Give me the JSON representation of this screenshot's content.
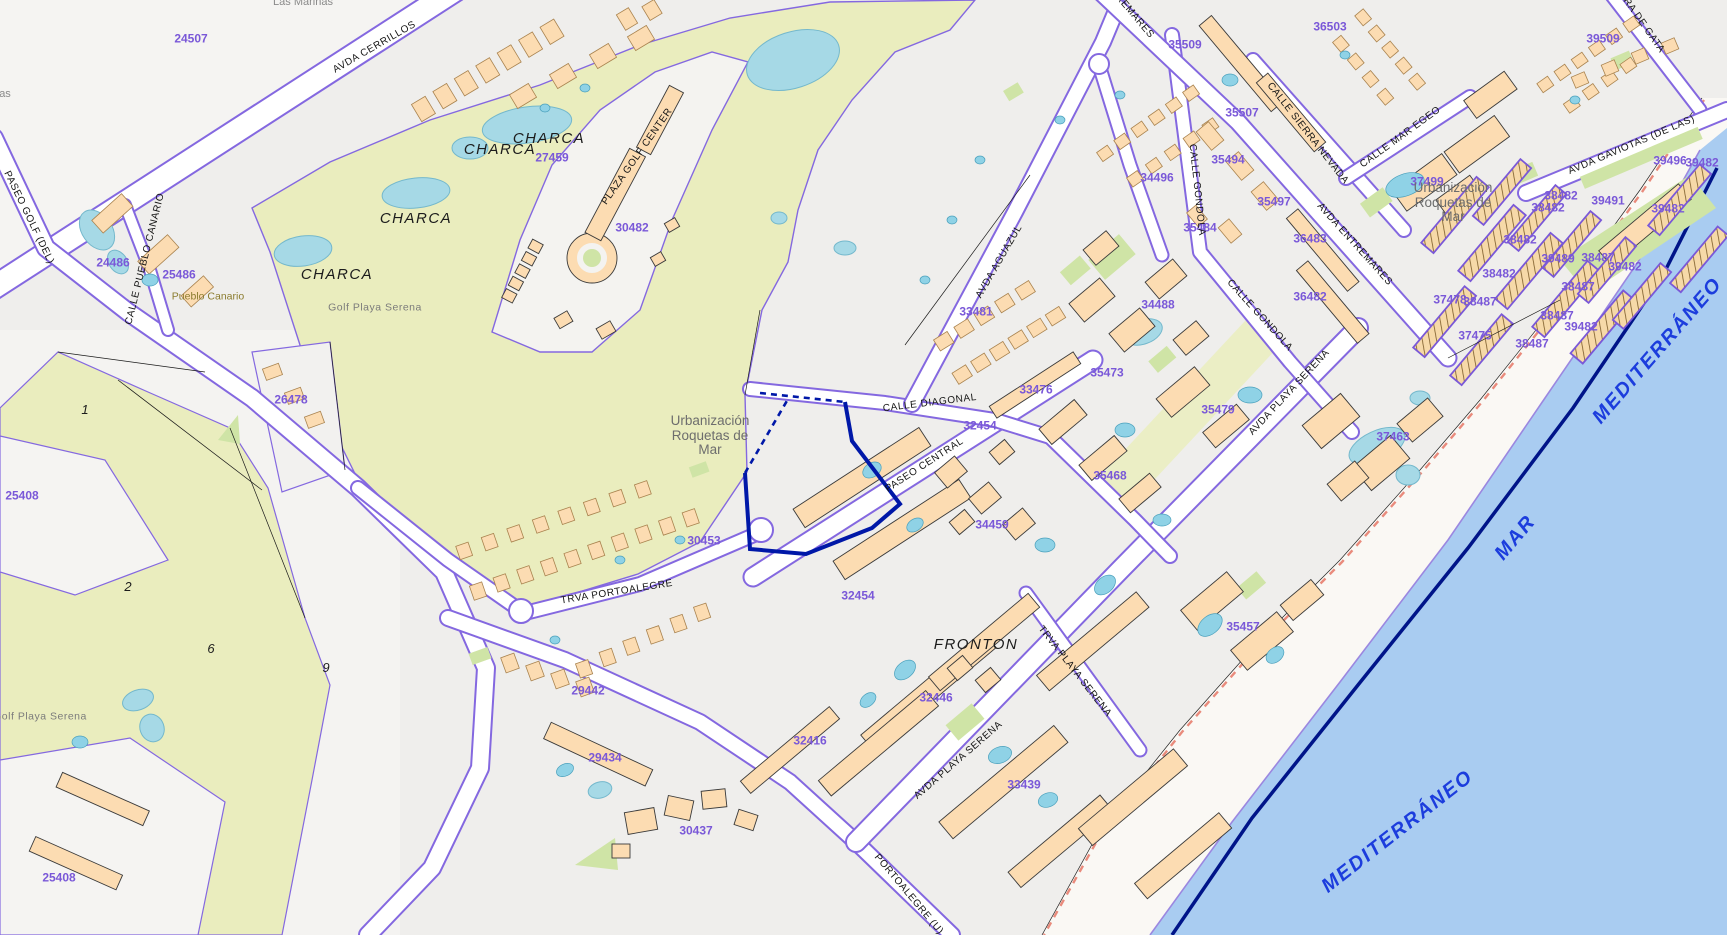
{
  "map": {
    "region_name": "Roquetas de Mar (cadastral plan)",
    "colors": {
      "parcel_number": "#7a58d8",
      "boundary_purple": "#8468e0",
      "selected_parcel": "#0018a8",
      "street_text": "#141414",
      "water_text": "#1c3ddd",
      "golf_green": "#eaedbe",
      "lawn_green": "#cfe4a6",
      "building_peach": "#fcdcb2",
      "pool_cyan": "#9fd8e8",
      "sea_blue": "#a9ccf1",
      "road_white": "#ffffff",
      "sand": "#faf8f4",
      "shore_dash_red": "#e98b7c"
    },
    "labels": [
      {
        "t": "Las Marinas",
        "x": 303,
        "y": 3,
        "r": 0,
        "c": "faded"
      },
      {
        "t": "as",
        "x": 5,
        "y": 95,
        "r": 0,
        "c": "faded"
      },
      {
        "t": "24507",
        "x": 191,
        "y": 39,
        "r": 0,
        "c": "num"
      },
      {
        "t": "24486",
        "x": 113,
        "y": 263,
        "r": 0,
        "c": "num"
      },
      {
        "t": "25486",
        "x": 179,
        "y": 275,
        "r": 0,
        "c": "num"
      },
      {
        "t": "26478",
        "x": 291,
        "y": 400,
        "r": 0,
        "c": "num"
      },
      {
        "t": "25408",
        "x": 22,
        "y": 496,
        "r": 0,
        "c": "num"
      },
      {
        "t": "25408",
        "x": 59,
        "y": 878,
        "r": 0,
        "c": "num"
      },
      {
        "t": "27459",
        "x": 552,
        "y": 158,
        "r": 0,
        "c": "num"
      },
      {
        "t": "30482",
        "x": 632,
        "y": 228,
        "r": 0,
        "c": "num"
      },
      {
        "t": "30453",
        "x": 704,
        "y": 541,
        "r": 0,
        "c": "num"
      },
      {
        "t": "29442",
        "x": 588,
        "y": 691,
        "r": 0,
        "c": "num"
      },
      {
        "t": "29434",
        "x": 605,
        "y": 758,
        "r": 0,
        "c": "num"
      },
      {
        "t": "30437",
        "x": 696,
        "y": 831,
        "r": 0,
        "c": "num"
      },
      {
        "t": "32454",
        "x": 980,
        "y": 426,
        "r": 0,
        "c": "num"
      },
      {
        "t": "32454",
        "x": 858,
        "y": 596,
        "r": 0,
        "c": "num"
      },
      {
        "t": "32446",
        "x": 936,
        "y": 698,
        "r": 0,
        "c": "num"
      },
      {
        "t": "32416",
        "x": 810,
        "y": 741,
        "r": 0,
        "c": "num"
      },
      {
        "t": "33439",
        "x": 1024,
        "y": 785,
        "r": 0,
        "c": "num"
      },
      {
        "t": "33481",
        "x": 976,
        "y": 312,
        "r": 0,
        "c": "num"
      },
      {
        "t": "33476",
        "x": 1036,
        "y": 390,
        "r": 0,
        "c": "num"
      },
      {
        "t": "34459",
        "x": 992,
        "y": 525,
        "r": 0,
        "c": "num"
      },
      {
        "t": "34488",
        "x": 1158,
        "y": 305,
        "r": 0,
        "c": "num"
      },
      {
        "t": "34496",
        "x": 1157,
        "y": 178,
        "r": 0,
        "c": "num"
      },
      {
        "t": "35494",
        "x": 1228,
        "y": 160,
        "r": 0,
        "c": "num"
      },
      {
        "t": "35497",
        "x": 1274,
        "y": 202,
        "r": 0,
        "c": "num"
      },
      {
        "t": "35484",
        "x": 1200,
        "y": 228,
        "r": 0,
        "c": "num"
      },
      {
        "t": "35507",
        "x": 1242,
        "y": 113,
        "r": 0,
        "c": "num"
      },
      {
        "t": "35509",
        "x": 1185,
        "y": 45,
        "r": 0,
        "c": "num"
      },
      {
        "t": "36503",
        "x": 1330,
        "y": 27,
        "r": 0,
        "c": "num"
      },
      {
        "t": "36483",
        "x": 1310,
        "y": 239,
        "r": 0,
        "c": "num"
      },
      {
        "t": "36482",
        "x": 1310,
        "y": 297,
        "r": 0,
        "c": "num"
      },
      {
        "t": "35479",
        "x": 1218,
        "y": 410,
        "r": 0,
        "c": "num"
      },
      {
        "t": "35473",
        "x": 1107,
        "y": 373,
        "r": 0,
        "c": "num"
      },
      {
        "t": "35468",
        "x": 1110,
        "y": 476,
        "r": 0,
        "c": "num"
      },
      {
        "t": "35457",
        "x": 1243,
        "y": 627,
        "r": 0,
        "c": "num"
      },
      {
        "t": "37463",
        "x": 1393,
        "y": 437,
        "r": 0,
        "c": "num"
      },
      {
        "t": "37499",
        "x": 1427,
        "y": 182,
        "r": 0,
        "c": "num"
      },
      {
        "t": "37475",
        "x": 1475,
        "y": 336,
        "r": 0,
        "c": "num"
      },
      {
        "t": "37478",
        "x": 1450,
        "y": 300,
        "r": 0,
        "c": "num"
      },
      {
        "t": "38487",
        "x": 1480,
        "y": 302,
        "r": 0,
        "c": "num"
      },
      {
        "t": "39509",
        "x": 1603,
        "y": 39,
        "r": 0,
        "c": "num"
      },
      {
        "t": "39496",
        "x": 1670,
        "y": 161,
        "r": 0,
        "c": "num"
      },
      {
        "t": "39482",
        "x": 1702,
        "y": 163,
        "r": 0,
        "c": "num"
      },
      {
        "t": "39491",
        "x": 1608,
        "y": 201,
        "r": 0,
        "c": "num"
      },
      {
        "t": "39482",
        "x": 1668,
        "y": 209,
        "r": 0,
        "c": "num"
      },
      {
        "t": "38482",
        "x": 1561,
        "y": 196,
        "r": 0,
        "c": "num"
      },
      {
        "t": "38482",
        "x": 1548,
        "y": 208,
        "r": 0,
        "c": "num"
      },
      {
        "t": "38482",
        "x": 1520,
        "y": 240,
        "r": 0,
        "c": "num"
      },
      {
        "t": "38482",
        "x": 1499,
        "y": 274,
        "r": 0,
        "c": "num"
      },
      {
        "t": "39489",
        "x": 1558,
        "y": 259,
        "r": 0,
        "c": "num"
      },
      {
        "t": "38487",
        "x": 1598,
        "y": 258,
        "r": 0,
        "c": "num"
      },
      {
        "t": "39482",
        "x": 1625,
        "y": 267,
        "r": 0,
        "c": "num"
      },
      {
        "t": "38487",
        "x": 1578,
        "y": 287,
        "r": 0,
        "c": "num"
      },
      {
        "t": "38487",
        "x": 1557,
        "y": 316,
        "r": 0,
        "c": "num"
      },
      {
        "t": "39482",
        "x": 1581,
        "y": 327,
        "r": 0,
        "c": "num"
      },
      {
        "t": "38487",
        "x": 1532,
        "y": 344,
        "r": 0,
        "c": "num"
      },
      {
        "t": "1",
        "x": 85,
        "y": 410,
        "r": 0,
        "c": "plot"
      },
      {
        "t": "2",
        "x": 128,
        "y": 587,
        "r": 0,
        "c": "plot"
      },
      {
        "t": "6",
        "x": 211,
        "y": 649,
        "r": 0,
        "c": "plot"
      },
      {
        "t": "9",
        "x": 326,
        "y": 668,
        "r": 0,
        "c": "plot"
      },
      {
        "t": "AVDA CERRILLOS",
        "x": 375,
        "y": 48,
        "r": -30,
        "c": "street"
      },
      {
        "t": "PASEO GOLF (DEL)",
        "x": 28,
        "y": 218,
        "r": 64,
        "c": "street"
      },
      {
        "t": "CALLE PUEBLO CANARIO",
        "x": 146,
        "y": 259,
        "r": -76,
        "c": "street"
      },
      {
        "t": "PLAZA GOLF CENTER",
        "x": 638,
        "y": 157,
        "r": -55,
        "c": "street"
      },
      {
        "t": "CALLE DIAGONAL",
        "x": 930,
        "y": 404,
        "r": -7,
        "c": "street"
      },
      {
        "t": "PASEO CENTRAL",
        "x": 925,
        "y": 466,
        "r": -33,
        "c": "street"
      },
      {
        "t": "TRVA PORTOALEGRE",
        "x": 617,
        "y": 593,
        "r": -9,
        "c": "street"
      },
      {
        "t": "AVDA AGUAZUL",
        "x": 1000,
        "y": 262,
        "r": -60,
        "c": "street"
      },
      {
        "t": "CALLE GONDOLA",
        "x": 1196,
        "y": 190,
        "r": 84,
        "c": "street"
      },
      {
        "t": "CALLE GONDOLA",
        "x": 1259,
        "y": 316,
        "r": 48,
        "c": "street"
      },
      {
        "t": "REMARES",
        "x": 1134,
        "y": 17,
        "r": 50,
        "c": "street"
      },
      {
        "t": "AVDA ENTREMARES",
        "x": 1354,
        "y": 245,
        "r": 48,
        "c": "street"
      },
      {
        "t": "CALLE SIERRA NEVADA",
        "x": 1307,
        "y": 134,
        "r": 52,
        "c": "street"
      },
      {
        "t": "CALLE MAR EGEO",
        "x": 1401,
        "y": 138,
        "r": -36,
        "c": "street"
      },
      {
        "t": "RA DE GATA",
        "x": 1643,
        "y": 26,
        "r": 55,
        "c": "street"
      },
      {
        "t": "AVDA GAVIOTAS (DE LAS)",
        "x": 1632,
        "y": 146,
        "r": -23,
        "c": "street"
      },
      {
        "t": "AVDA PLAYA SERENA",
        "x": 1290,
        "y": 393,
        "r": -47,
        "c": "street"
      },
      {
        "t": "AVDA PLAYA SERENA",
        "x": 959,
        "y": 761,
        "r": -41,
        "c": "street"
      },
      {
        "t": "TRVA PLAYA SERENA",
        "x": 1074,
        "y": 672,
        "r": 52,
        "c": "street"
      },
      {
        "t": "PORTOALEGRE (U)",
        "x": 908,
        "y": 895,
        "r": 50,
        "c": "street"
      },
      {
        "t": "CHARCA",
        "x": 500,
        "y": 150,
        "r": 0,
        "c": "charca"
      },
      {
        "t": "CHARCA",
        "x": 549,
        "y": 139,
        "r": 0,
        "c": "charca"
      },
      {
        "t": "CHARCA",
        "x": 416,
        "y": 219,
        "r": 0,
        "c": "charca"
      },
      {
        "t": "CHARCA",
        "x": 337,
        "y": 275,
        "r": 0,
        "c": "charca"
      },
      {
        "t": "FRONTON",
        "x": 976,
        "y": 645,
        "r": 0,
        "c": "charca"
      },
      {
        "t": "Golf Playa Serena",
        "x": 375,
        "y": 308,
        "r": 0,
        "c": "small-place"
      },
      {
        "t": "Golf Playa Serena",
        "x": 40,
        "y": 717,
        "r": 0,
        "c": "small-place"
      },
      {
        "t": "Pueblo Canario",
        "x": 208,
        "y": 297,
        "r": 0,
        "c": "poi"
      },
      {
        "t": "Urbanización\nRoquetas de\nMar",
        "x": 710,
        "y": 436,
        "r": 0,
        "c": "place"
      },
      {
        "t": "Urbanización\nRoquetas de\nMar",
        "x": 1453,
        "y": 203,
        "r": 0,
        "c": "place"
      },
      {
        "t": "MAR",
        "x": 1516,
        "y": 538,
        "r": -50,
        "c": "water"
      },
      {
        "t": "MEDITERRÁNEO",
        "x": 1658,
        "y": 351,
        "r": -49,
        "c": "water"
      },
      {
        "t": "MEDITERRÁNEO",
        "x": 1398,
        "y": 832,
        "r": -38,
        "c": "water"
      }
    ]
  }
}
